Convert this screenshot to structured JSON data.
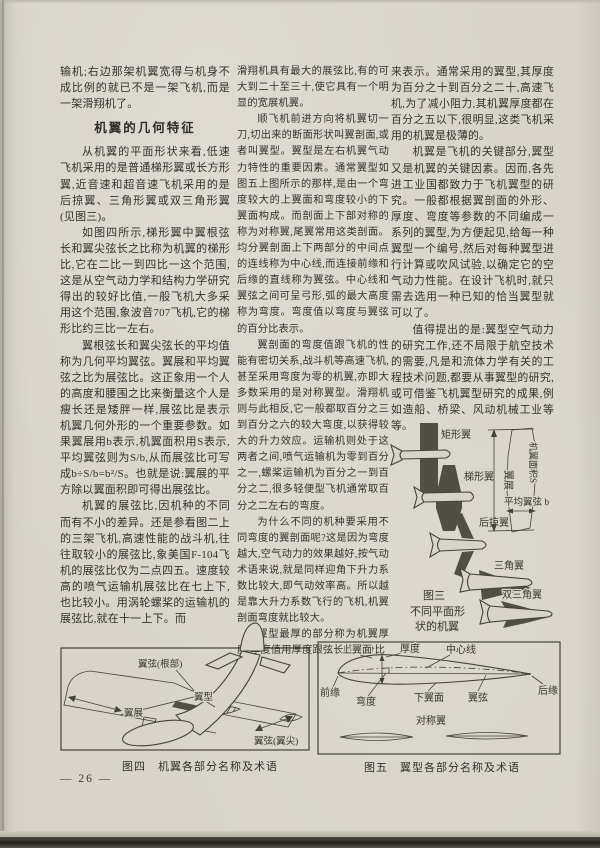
{
  "colors": {
    "paper": "#d8d4ca",
    "ink": "#38352f",
    "figure_fill": "#514e45"
  },
  "page": {
    "number": "— 26 —"
  },
  "columns": {
    "left": {
      "p1": "输机;右边那架机翼宽得与机身不成比例的就已不是一架飞机,而是一架滑翔机了。",
      "heading": "机翼的几何特征",
      "p2": "从机翼的平面形状来看,低速飞机采用的是普通梯形翼或长方形翼,近音速和超音速飞机采用的是后掠翼、三角形翼或双三角形翼(见图三)。",
      "p3": "如图四所示,梯形翼中翼根弦长和翼尖弦长之比称为机翼的梯形比,它在二比一到四比一这个范围,这是从空气动力学和结构力学研究得出的较好比值,一般飞机大多采用这个范围,象波音707飞机,它的梯形比约三比一左右。",
      "p4": "翼根弦长和翼尖弦长的平均值称为几何平均翼弦。翼展和平均翼弦之比为展弦比。这正象用一个人的高度和腰围之比来衡量这个人是瘦长还是矮胖一样,展弦比是表示机翼几何外形的一个重要参数。如果翼展用b表示,机翼面积用S表示,平均翼弦则为S/b,从而展弦比可写成b÷S/b=b²/S。也就是说:翼展的平方除以翼面积即可得出展弦比。",
      "p5": "机翼的展弦比,因机种的不同而有不小的差异。还是参看图二上的三架飞机,高速性能的战斗机,往往取较小的展弦比,象美国F-104飞机的展弦比仅为二点四五。速度较高的喷气运输机展弦比在七上下,也比较小。用涡轮螺桨的运输机的展弦比,就在十一上下。而"
    },
    "middle": {
      "p1": "滑翔机具有最大的展弦比,有的可大到二十至三十,使它具有一个明显的宽展机翼。",
      "p2": "顺飞机前进方向将机翼切一刀,切出来的断面形状叫翼剖面,或者叫翼型。翼型是左右机翼气动力特性的重要因素。通常翼型如图五上图所示的那样,是由一个弯度较大的上翼面和弯度较小的下翼面构成。而剖面上下部对称的称为对称翼,尾翼常用这类剖面。均分翼剖面上下两部分的中间点的连线称为中心线,而连接前缘和后缘的直线称为翼弦。中心线和翼弦之间可呈弓形,弧的最大高度称为弯度。弯度值以弯度与翼弦的百分比表示。",
      "p3": "翼剖面的弯度值跟飞机的性能有密切关系,战斗机等高速飞机,甚至采用弯度为零的机翼,亦即大多数采用的是对称翼型。滑翔机则与此相反,它一般都取百分之三到百分之六的较大弯度,以获得较大的升力效应。运输机则处于这两者之间,喷气运输机为零到百分之一,螺桨运输机为百分之一到百分之二,很多轻便型飞机通常取百分之二左右的弯度。",
      "p4": "为什么不同的机种要采用不同弯度的翼剖面呢?这是因为弯度越大,空气动力的效果越好,按气动术语来说,就是同样迎角下升力系数比较大,即气动效率高。所以越是靠大升力系数飞行的飞机,机翼剖面弯度就比较大。",
      "p5": "翼型最厚的部分称为机翼厚度,厚度值用厚度跟弦长的百分比"
    },
    "right": {
      "p1": "来表示。通常采用的翼型,其厚度为百分之十到百分之二十,高速飞机,为了减小阻力,其机翼厚度都在百分之五以下,很明显,这类飞机采用的机翼是极薄的。",
      "p2": "机翼是飞机的关键部分,翼型又是机翼的关键因素。因而,各先进工业国都致力于飞机翼型的研究。一般都根据翼剖面的外形、厚度、弯度等参数的不同编成一系列的翼型,为方便起见,给每一种翼型一个编号,然后对每种翼型进行计算或吹风试验,以确定它的空气动力性能。在设计飞机时,就只需去选用一种已知的恰当翼型就可以了。",
      "p3": "值得提出的是:翼型空气动力的研究工作,还不局限于航空技术的需要,凡是和流体力学有关的工程技术问题,都要从事翼型的研究,或可借鉴飞机翼型研究的成果,例如造船、桥梁、风动机械工业等等。"
    }
  },
  "figure3": {
    "labels": {
      "rectangular": "矩形翼",
      "trapezoid": "梯形翼",
      "swept": "后掠翼",
      "delta": "三角翼",
      "double_delta": "双三角翼",
      "span": "翼展",
      "area": "机翼面积S",
      "mean_chord": "平均翼弦 b"
    },
    "caption": [
      "图三",
      "不同平面形",
      "状的机翼"
    ]
  },
  "figure4": {
    "labels": {
      "root_chord": "翼弦(根部)",
      "airfoil": "翼型",
      "span": "翼展",
      "tip_chord": "翼弦(翼尖)"
    },
    "caption": "图四　机翼各部分名称及术语"
  },
  "figure5": {
    "labels": {
      "upper_surface": "上翼面",
      "thickness": "厚度",
      "center_line": "中心线",
      "leading_edge": "前缘",
      "camber": "弯度",
      "lower_surface": "下翼面",
      "chord": "翼弦",
      "trailing_edge": "后缘",
      "symmetric": "对称翼"
    },
    "caption": "图五　翼型各部分名称及术语"
  }
}
